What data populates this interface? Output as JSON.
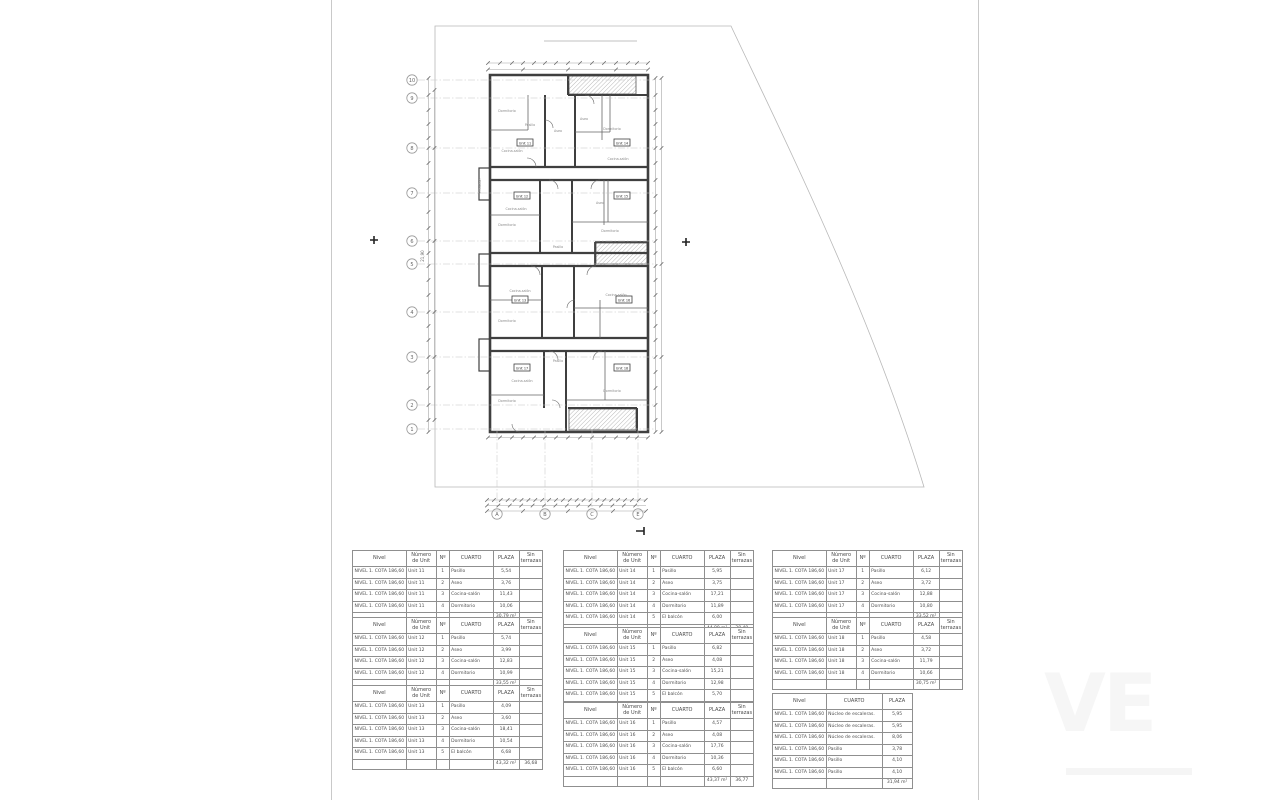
{
  "plan": {
    "grid_rows": [
      "10",
      "9",
      "8",
      "7",
      "6",
      "5",
      "4",
      "3",
      "2",
      "1"
    ],
    "grid_cols": [
      "A",
      "B",
      "C",
      "E"
    ],
    "total_dim_left": "21,90",
    "unit_badges": [
      "Unit 11",
      "Unit 14",
      "Unit 12",
      "Unit 15",
      "Unit 13",
      "Unit 16",
      "Unit 17",
      "Unit 18"
    ],
    "room_labels": [
      "Dormitorio",
      "Pasillo",
      "Aseo",
      "Dormitorio",
      "Cocina-salón",
      "Cocina-salón",
      "Aseo",
      "Dormitorio",
      "Cocina-salón",
      "Pasillo",
      "Dormitorio",
      "Cocina-salón",
      "Cocina-salón",
      "Dormitorio",
      "Aseo",
      "Dormitorio",
      "Cocina-salón",
      "Dormitorio",
      "Pasillo",
      "El balcón"
    ]
  },
  "tables": {
    "header": {
      "nivel": "Nivel",
      "numero": "Número de Unit",
      "num": "Nº",
      "cuarto": "CUARTO",
      "plaza": "PLAZA",
      "sin": "Sin terrazas"
    },
    "nivel_value": "NIVEL 1. COTA 186,60",
    "unit_tables": [
      {
        "unit": "Unit 11",
        "rows": [
          [
            "1",
            "Pasillo",
            "5,54"
          ],
          [
            "2",
            "Aseo",
            "3,76"
          ],
          [
            "3",
            "Cocina-salón",
            "11,43"
          ],
          [
            "4",
            "Dormitorio",
            "10,06"
          ]
        ],
        "total_plaza": "30,79 m²",
        "total_sin": ""
      },
      {
        "unit": "Unit 12",
        "rows": [
          [
            "1",
            "Pasillo",
            "5,74"
          ],
          [
            "2",
            "Aseo",
            "3,99"
          ],
          [
            "3",
            "Cocina-salón",
            "12,83"
          ],
          [
            "4",
            "Dormitorio",
            "10,99"
          ]
        ],
        "total_plaza": "33,55 m²",
        "total_sin": ""
      },
      {
        "unit": "Unit 13",
        "rows": [
          [
            "1",
            "Pasillo",
            "4,09"
          ],
          [
            "2",
            "Aseo",
            "3,60"
          ],
          [
            "3",
            "Cocina-salón",
            "18,41"
          ],
          [
            "4",
            "Dormitorio",
            "10,54"
          ],
          [
            "5",
            "El balcón",
            "6,68"
          ]
        ],
        "total_plaza": "43,32 m²",
        "total_sin": "36,68"
      },
      {
        "unit": "Unit 14",
        "rows": [
          [
            "1",
            "Pasillo",
            "5,95"
          ],
          [
            "2",
            "Aseo",
            "3,75"
          ],
          [
            "3",
            "Cocina-salón",
            "17,21"
          ],
          [
            "4",
            "Dormitorio",
            "11,89"
          ],
          [
            "5",
            "El balcón",
            "6,00"
          ]
        ],
        "total_plaza": "44,80 m²",
        "total_sin": "38,49"
      },
      {
        "unit": "Unit 15",
        "rows": [
          [
            "1",
            "Pasillo",
            "6,82"
          ],
          [
            "2",
            "Aseo",
            "4,08"
          ],
          [
            "3",
            "Cocina-salón",
            "15,21"
          ],
          [
            "4",
            "Dormitorio",
            "12,98"
          ],
          [
            "5",
            "El balcón",
            "5,70"
          ]
        ],
        "total_plaza": "44,79 m²",
        "total_sin": "39,09"
      },
      {
        "unit": "Unit 16",
        "rows": [
          [
            "1",
            "Pasillo",
            "4,57"
          ],
          [
            "2",
            "Aseo",
            "4,08"
          ],
          [
            "3",
            "Cocina-salón",
            "17,76"
          ],
          [
            "4",
            "Dormitorio",
            "10,36"
          ],
          [
            "5",
            "El balcón",
            "6,60"
          ]
        ],
        "total_plaza": "43,37 m²",
        "total_sin": "36,77"
      },
      {
        "unit": "Unit 17",
        "rows": [
          [
            "1",
            "Pasillo",
            "6,12"
          ],
          [
            "2",
            "Aseo",
            "3,72"
          ],
          [
            "3",
            "Cocina-salón",
            "12,88"
          ],
          [
            "4",
            "Dormitorio",
            "10,80"
          ]
        ],
        "total_plaza": "33,52 m²",
        "total_sin": ""
      },
      {
        "unit": "Unit 18",
        "rows": [
          [
            "1",
            "Pasillo",
            "4,58"
          ],
          [
            "2",
            "Aseo",
            "3,72"
          ],
          [
            "3",
            "Cocina-salón",
            "11,79"
          ],
          [
            "4",
            "Dormitorio",
            "10,66"
          ]
        ],
        "total_plaza": "30,75 m²",
        "total_sin": ""
      }
    ],
    "common_table": {
      "rows": [
        [
          "Núcleo de escaleras.",
          "5,95"
        ],
        [
          "Núcleo de escaleras.",
          "5,95"
        ],
        [
          "Núcleo de escaleras.",
          "8,06"
        ],
        [
          "Pasillo",
          "3,78"
        ],
        [
          "Pasillo",
          "4,10"
        ],
        [
          "Pasillo",
          "4,10"
        ]
      ],
      "total_plaza": "31,94 m²"
    }
  },
  "watermark": {
    "large_text": "VE"
  }
}
